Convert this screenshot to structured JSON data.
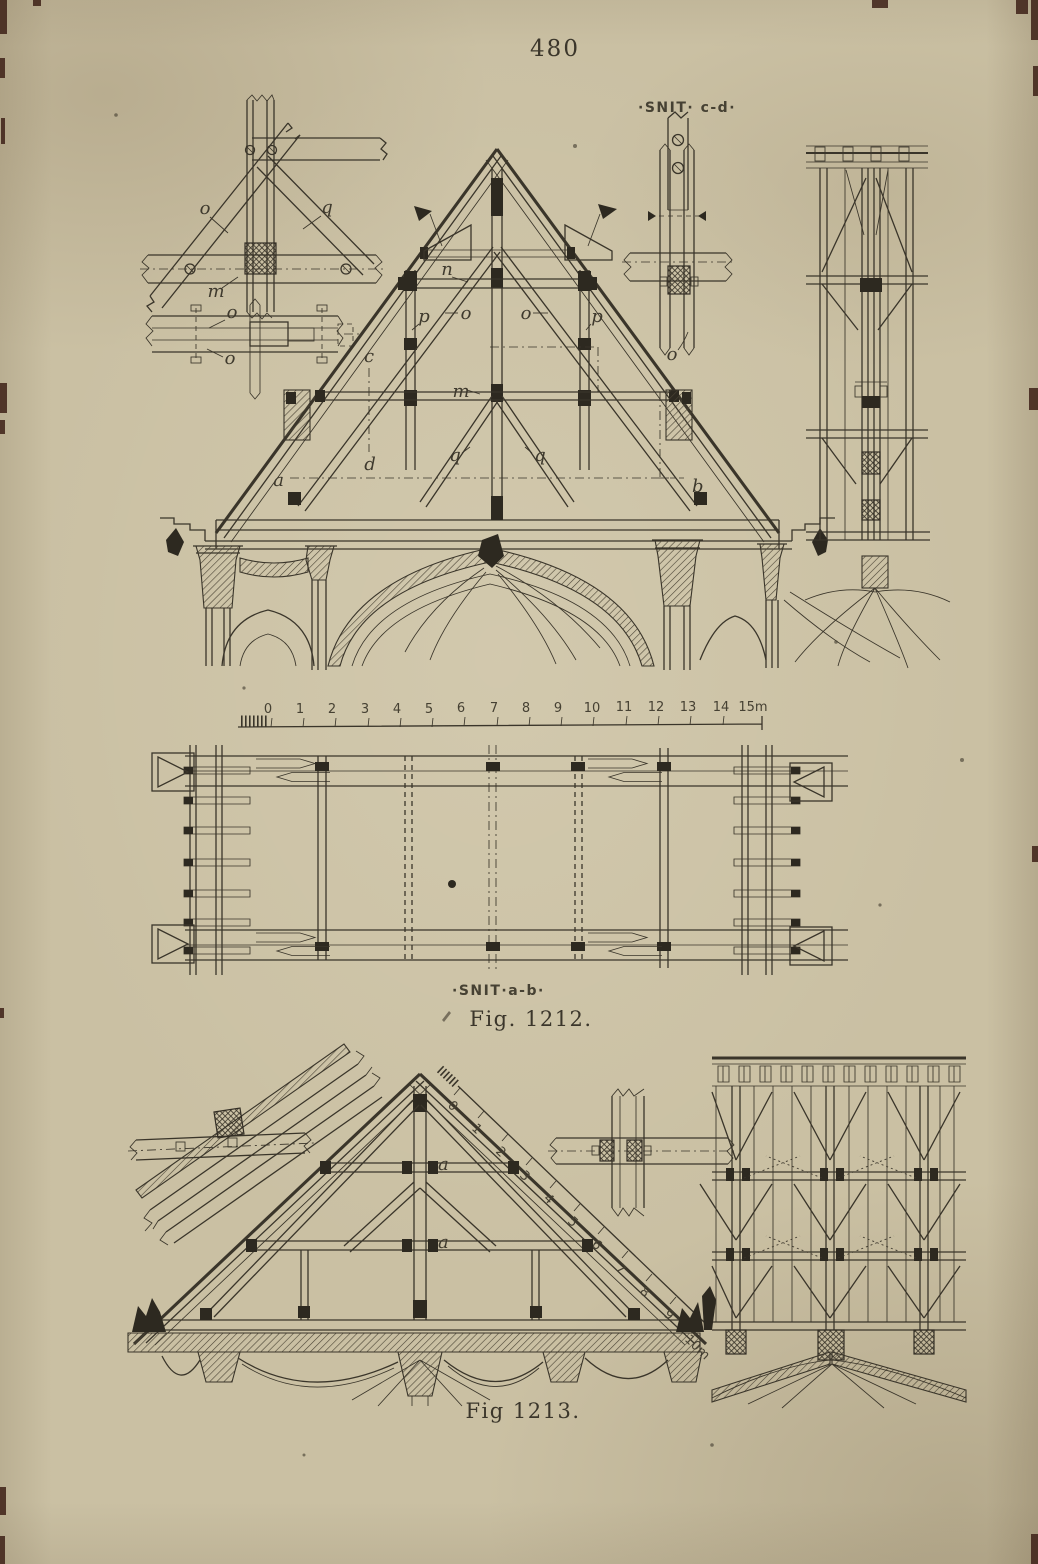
{
  "page": {
    "number": "480"
  },
  "fig1212": {
    "caption": "Fig. 1212.",
    "section_labels": {
      "cd": "·SNIT· c-d·",
      "ab": "·SNIT·a-b·"
    },
    "part_labels": {
      "o_detail": "o",
      "q_detail": "q",
      "m_detail": "m",
      "o_lap_top": "o",
      "o_lap_bottom": "o",
      "o_section": "o",
      "n": "n",
      "p_left": "p",
      "p_right": "p",
      "o_left": "o",
      "o_right": "o",
      "m": "m",
      "c": "c",
      "d": "d",
      "q_left": "q",
      "q_right": "q",
      "a": "a",
      "b": "b"
    },
    "scale": {
      "ticks": [
        "0",
        "1",
        "2",
        "3",
        "4",
        "5",
        "6",
        "7",
        "8",
        "9",
        "10",
        "11",
        "12",
        "13",
        "14",
        "15m"
      ]
    }
  },
  "fig1213": {
    "caption": "Fig 1213.",
    "part_labels": {
      "a_upper": "a",
      "a_lower": "a"
    },
    "scale": {
      "ticks": [
        "0",
        "1",
        "2",
        "3",
        "4",
        "5",
        "6",
        "7",
        "8",
        "9",
        "10m"
      ]
    }
  }
}
